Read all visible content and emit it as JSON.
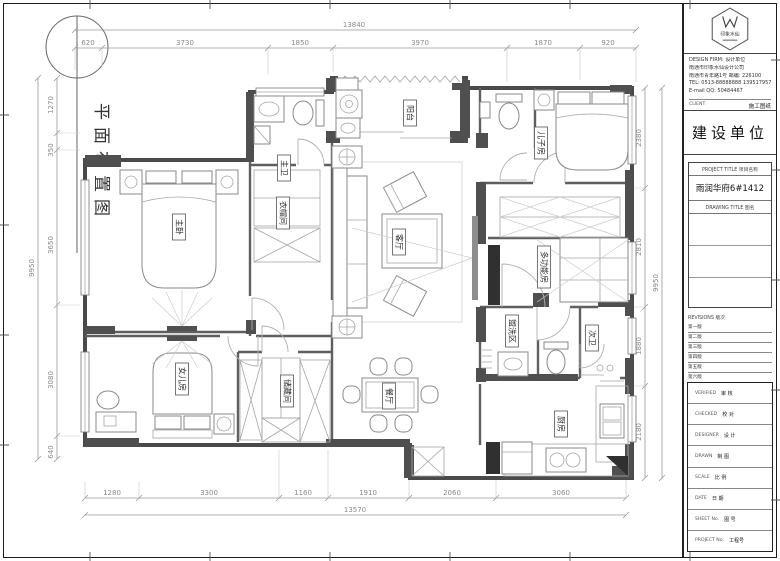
{
  "sheet": {
    "drawing_label": "平面布置图"
  },
  "plan": {
    "rooms": [
      {
        "name": "主卧"
      },
      {
        "name": "主卫"
      },
      {
        "name": "衣帽间"
      },
      {
        "name": "阳台"
      },
      {
        "name": "儿子房"
      },
      {
        "name": "客厅"
      },
      {
        "name": "多功能房"
      },
      {
        "name": "盥洗区"
      },
      {
        "name": "次卫"
      },
      {
        "name": "厨房"
      },
      {
        "name": "女儿房"
      },
      {
        "name": "储藏间"
      },
      {
        "name": "餐厅"
      }
    ],
    "dims": {
      "top_total": "13840",
      "top": [
        "620",
        "3730",
        "1850",
        "3970",
        "1870",
        "920"
      ],
      "left_total": "9950",
      "left": [
        "1270",
        "350",
        "3650",
        "3080",
        "640"
      ],
      "right_total": "9950",
      "right": [
        "2380",
        "2810",
        "1880",
        "2180"
      ],
      "bottom_total": "13570",
      "bottom": [
        "1280",
        "3300",
        "1160",
        "1910",
        "2060",
        "3060"
      ]
    }
  },
  "title_block": {
    "logo_name": "印象水仙",
    "design_firm_label": "DESIGN FIRM: 设计单位",
    "firm_lines": [
      "南通市印象水仙设计公司",
      "南通市青年路1号 邮编: 226100",
      "TEL: 0513-88888888  13951795718",
      "E-mail QQ: 50484467"
    ],
    "client_label": "CLIENT",
    "stage_label": "施工图纸",
    "client_title": "建设单位",
    "project_title_label": "PROJECT TITLE  项目名称",
    "project_name": "雨润华府6#1412",
    "drawing_title_label": "DRAWING TITLE  图名",
    "revisions_label": "REVISIONS 版次",
    "revisions": [
      "第一版",
      "第二版",
      "第三版",
      "第四版",
      "第五版",
      "第六版"
    ],
    "fields": [
      {
        "en": "VERIFIED",
        "zh": "审 核"
      },
      {
        "en": "CHECKED",
        "zh": "校 对"
      },
      {
        "en": "DESIGNER",
        "zh": "设 计"
      },
      {
        "en": "DRAWN",
        "zh": "制 图"
      },
      {
        "en": "SCALE",
        "zh": "比 例"
      },
      {
        "en": "DATE",
        "zh": "日 期"
      },
      {
        "en": "SHEET No.",
        "zh": "图 号"
      },
      {
        "en": "PROJECT No.",
        "zh": "工程号"
      }
    ]
  }
}
